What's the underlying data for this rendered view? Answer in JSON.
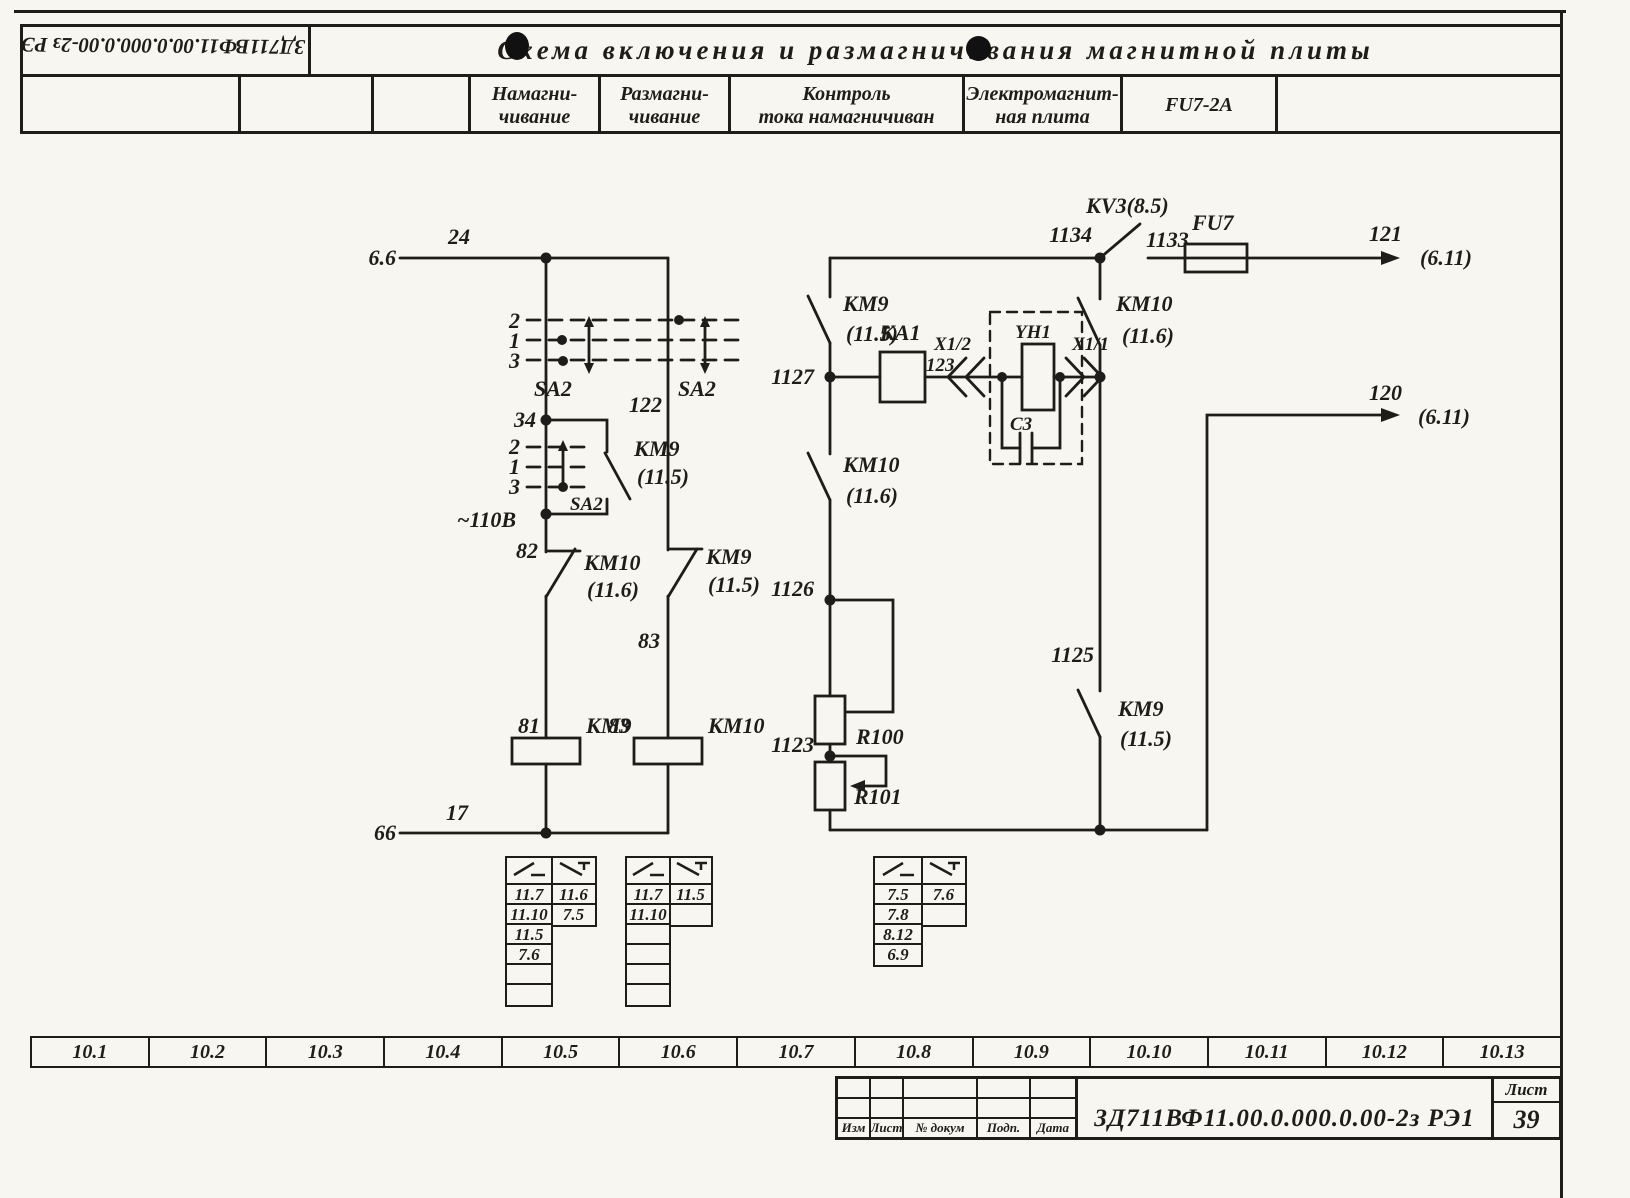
{
  "header": {
    "stamp": "ЗД711ВФ11.00.0.000.0.00-2з РЭ1",
    "title": "Схема  включения  и  размагничивания  магнитной  плиты",
    "columns": [
      {
        "l1": "Намагни-",
        "l2": "чивание"
      },
      {
        "l1": "Размагни-",
        "l2": "чивание"
      },
      {
        "l1": "Контроль",
        "l2": "тока намагничиван"
      },
      {
        "l1": "Электромагнит-",
        "l2": "ная плита"
      },
      {
        "l1": "FU7-2А",
        "l2": ""
      }
    ]
  },
  "labels": {
    "ref_top": "6.6",
    "wire24": "24",
    "p2": "2",
    "p1": "1",
    "p3": "3",
    "sa2": "SA2",
    "wire122": "122",
    "n34": "34",
    "km9": "КМ9",
    "km9_ref": "(11.5)",
    "km10": "КМ10",
    "km10_ref": "(11.6)",
    "v110": "~110В",
    "n82": "82",
    "wire83": "83",
    "n81": "81",
    "n83": "83",
    "ref_bot": "66",
    "wire17": "17",
    "kv3": "КV3(8.5)",
    "n1134": "1134",
    "n1133": "1133",
    "fu7": "FU7",
    "w121": "121",
    "w120": "120",
    "dest": "(6.11)",
    "n1127": "1127",
    "ka1": "КА1",
    "w123": "123",
    "x12": "X1/2",
    "yh1": "YH1",
    "x11": "X1/1",
    "c3": "С3",
    "n1126": "1126",
    "r100": "R100",
    "n1123": "1123",
    "r101": "R101",
    "n1125": "1125"
  },
  "tables": {
    "km9": {
      "no": [
        "11.7",
        "11.10",
        "11.5",
        "7.6",
        "",
        ""
      ],
      "nc": [
        "11.6",
        "7.5"
      ]
    },
    "km10": {
      "no": [
        "11.7",
        "11.10",
        "",
        "",
        "",
        ""
      ],
      "nc": [
        "11.5",
        ""
      ]
    },
    "ka1": {
      "no": [
        "7.5",
        "7.8",
        "8.12",
        "6.9"
      ],
      "nc": [
        "7.6",
        ""
      ]
    }
  },
  "strip": {
    "cells": [
      "10.1",
      "10.2",
      "10.3",
      "10.4",
      "10.5",
      "10.6",
      "10.7",
      "10.8",
      "10.9",
      "10.10",
      "10.11",
      "10.12",
      "10.13"
    ]
  },
  "titleblock": {
    "rev_labels": [
      "Изм",
      "Лист",
      "№ докум",
      "Подп.",
      "Дата"
    ],
    "doc": "ЗД711ВФ11.00.0.000.0.00-2з РЭ1",
    "sheet_label": "Лист",
    "sheet_no": "39"
  }
}
